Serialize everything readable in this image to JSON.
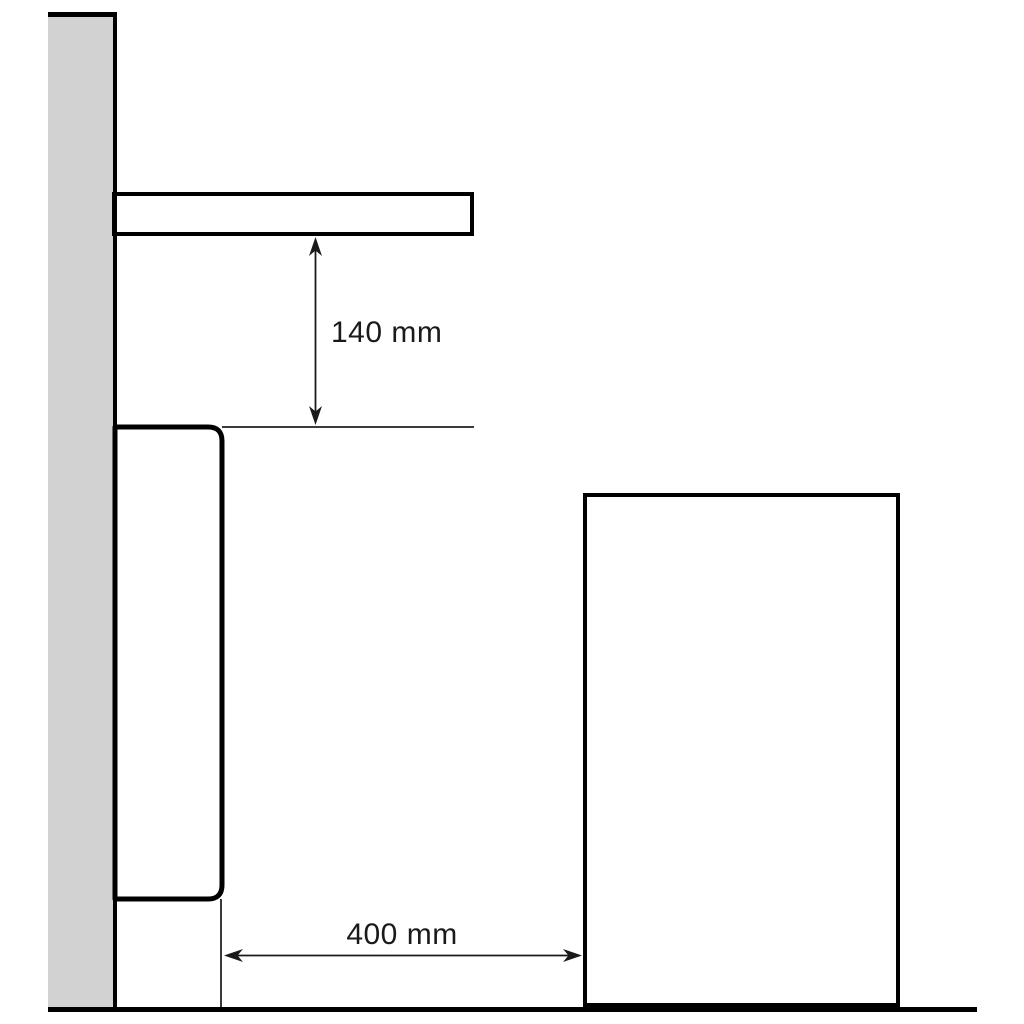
{
  "diagram": {
    "kind": "installation-clearance-diagram",
    "labels": {
      "top_clearance": "140 mm",
      "side_clearance": "400 mm"
    },
    "colors": {
      "shape_fill": "#d2d2d2",
      "outline": "#000000",
      "thin_line": "#3a3a3a",
      "dimension": "#1a1a1a",
      "background": "#ffffff"
    }
  }
}
